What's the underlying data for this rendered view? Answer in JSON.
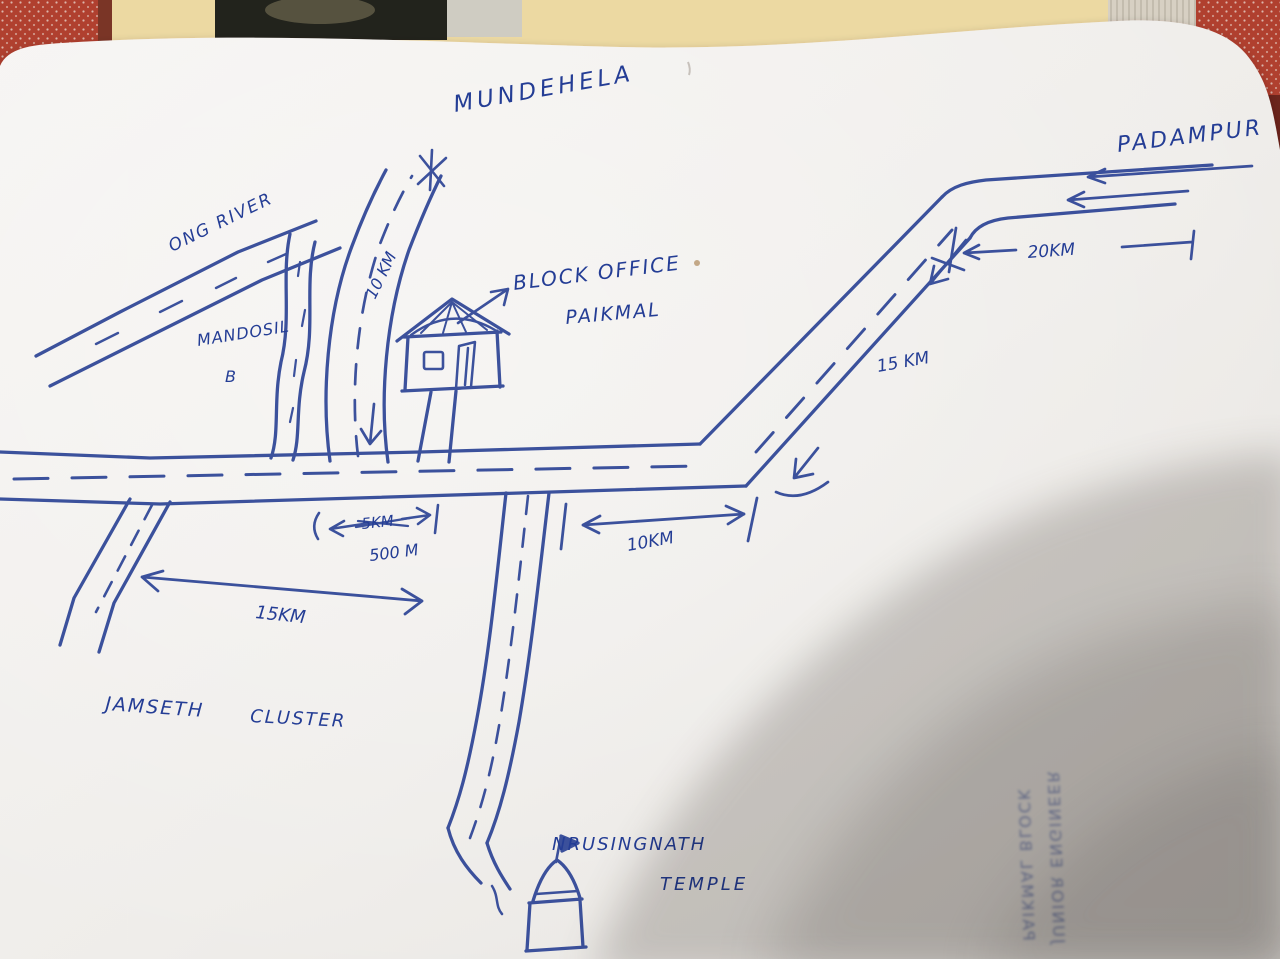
{
  "places": {
    "mundehela": "MUNDEHELA",
    "padampur": "PADAMPUR",
    "ong_river": "ONG RIVER",
    "mandosil": "MANDOSIL",
    "mandosil_b": "B",
    "block_office_line1": "BLOCK OFFICE",
    "block_office_line2": "PAIKMAL",
    "jamseth": "JAMSETH",
    "cluster": "CLUSTER",
    "temple_line1": "NRUSINGNATH",
    "temple_line2": "TEMPLE"
  },
  "distances": {
    "mundehela_road": "10 KM",
    "padampur_segment": "20KM",
    "diagonal_road": "15 KM",
    "office_span_struck": "5KM",
    "office_span_corrected": "500 M",
    "temple_junction_east": "10KM",
    "jamseth_road": "15KM"
  },
  "bleedthrough": {
    "line1": "JUNIOR ENGINEER",
    "line2": "PAIKMAL BLOCK"
  },
  "colors": {
    "ink_blue": "#2e4596",
    "paper": "#f1eeeb",
    "fabric_red": "#b0402f",
    "notebook_cream": "#ecd9a2",
    "shadow": "#5d5854"
  }
}
